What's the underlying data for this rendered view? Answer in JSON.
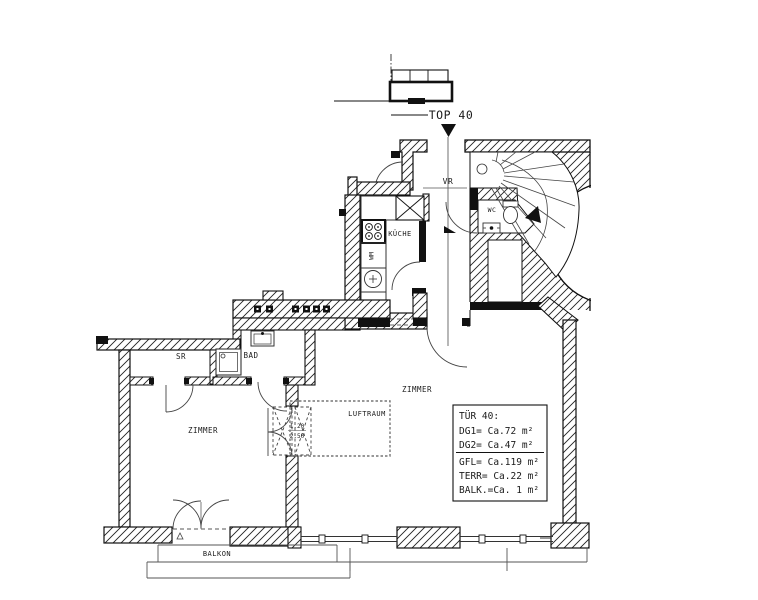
{
  "plan": {
    "title_label": "TOP 40",
    "rooms": {
      "vr": "VR",
      "wc": "WC",
      "kueche": "KÜCHE",
      "wm": "WM",
      "sr": "SR",
      "bad": "BAD",
      "zimmer_left": "ZIMMER",
      "zimmer_main": "ZIMMER",
      "luftraum": "LUFTRAUM",
      "balkon": "BALKON"
    },
    "ladder_dims": {
      "top": "1.20",
      "bottom": "2.50"
    },
    "info_box": {
      "lines": [
        "TÜR 40:",
        "DG1= Ca.72 m²",
        "DG2=  Ca.47 m²",
        "GFL=  Ca.119 m²",
        "TERR= Ca.22 m²",
        "BALK.=Ca. 1 m²"
      ]
    },
    "colors": {
      "background": "#ffffff",
      "line": "#000000"
    }
  }
}
